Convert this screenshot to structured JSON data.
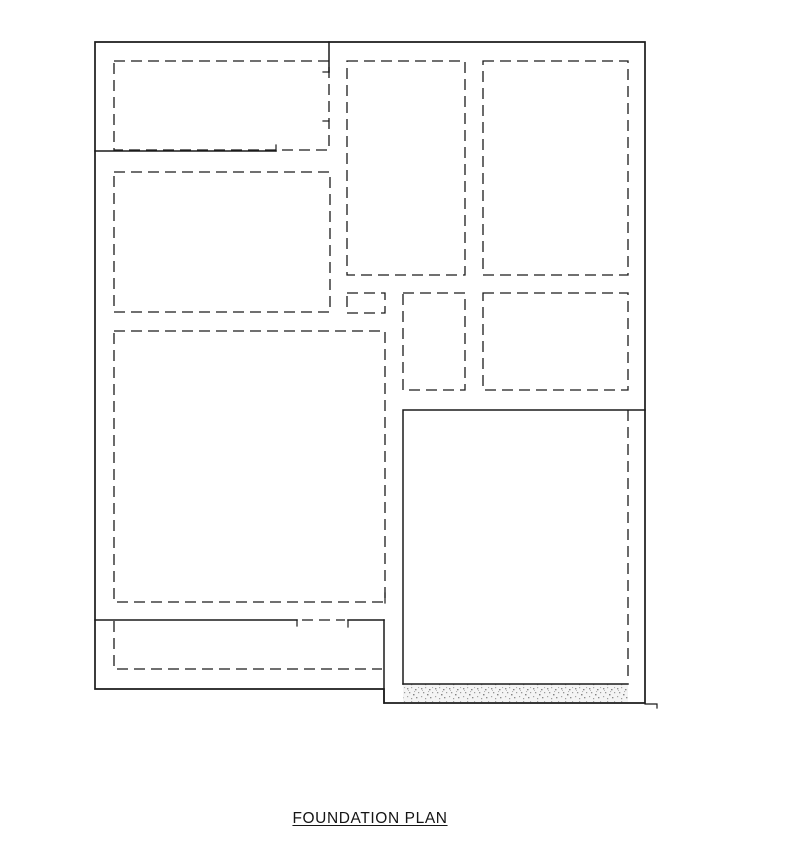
{
  "drawing": {
    "title": "FOUNDATION PLAN",
    "colors": {
      "background": "#ffffff",
      "line": "#1b1b1b",
      "stipple": "#9a9a9a"
    },
    "elements": {
      "outer_wall": "solid foundation perimeter with stepped bottom-right corner",
      "footings": "dashed footing outlines",
      "stipple_band": "hatched earth/concrete band at bottom of garage slab"
    }
  }
}
